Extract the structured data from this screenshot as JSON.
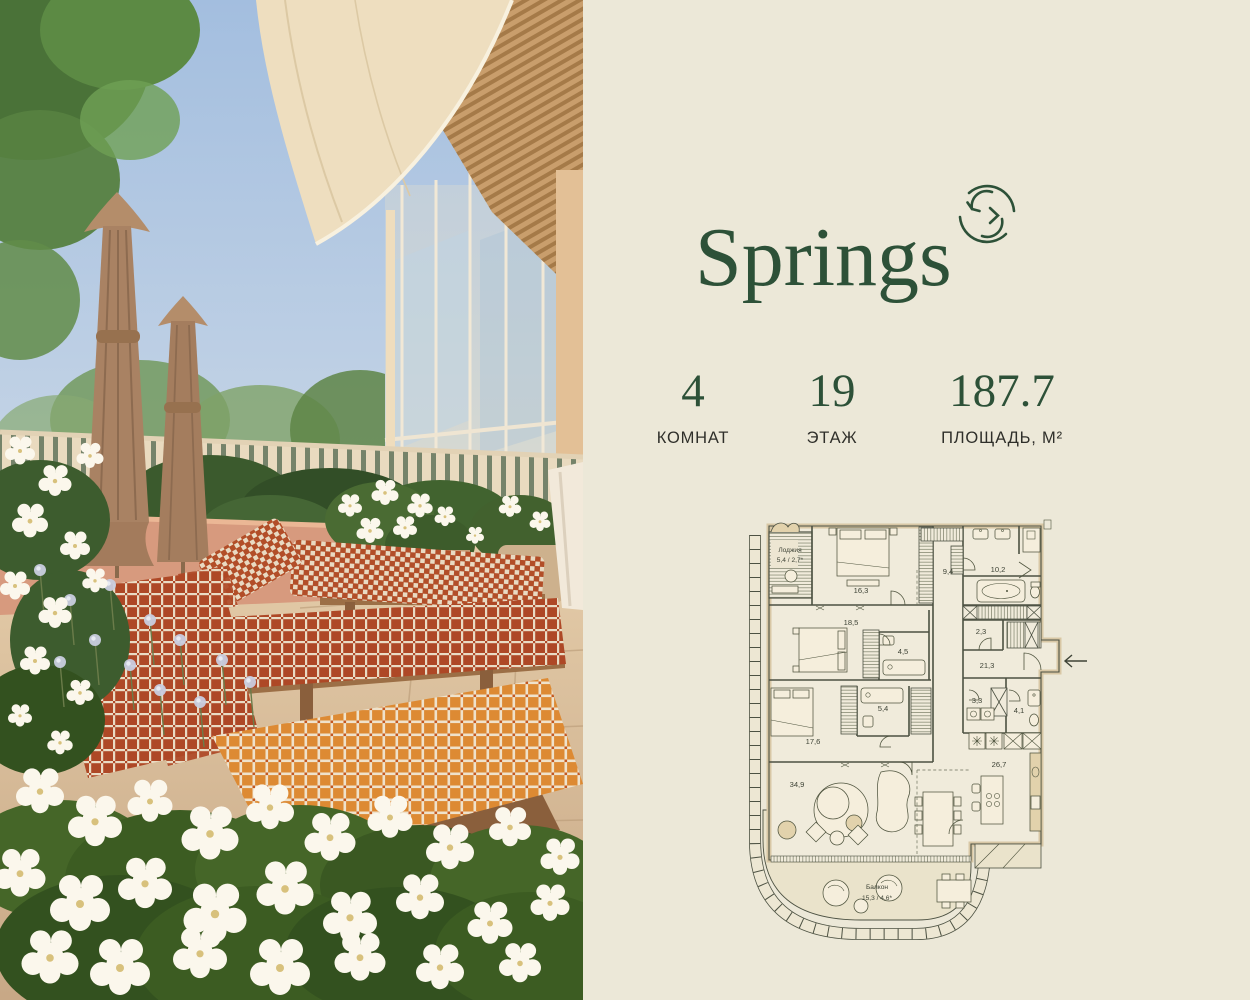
{
  "brand": {
    "name": "Springs",
    "accent_color": "#2D5138",
    "background_color": "#ECE8D8"
  },
  "stats": {
    "items": [
      {
        "value": "4",
        "label": "КОМНАТ"
      },
      {
        "value": "19",
        "label": "ЭТАЖ"
      },
      {
        "value": "187.7",
        "label": "ПЛОЩАДЬ, М²"
      }
    ]
  },
  "floor_plan": {
    "loggia": {
      "name": "Лоджия",
      "area": "5,4 / 2,7*"
    },
    "balcony": {
      "name": "Балкон",
      "area": "15,3 / 4,6*"
    },
    "room_areas": [
      "16,3",
      "9,4",
      "10,2",
      "18,5",
      "2,3",
      "4,5",
      "21,3",
      "5,4",
      "3,3",
      "4,1",
      "17,6",
      "34,9",
      "26,7"
    ],
    "line_color": "#4C5142",
    "wall_fill": "#D8C7A5"
  },
  "photo": {
    "subject": "terrace with checkered lounge chairs, closed umbrellas, white flowers and glass facade"
  }
}
